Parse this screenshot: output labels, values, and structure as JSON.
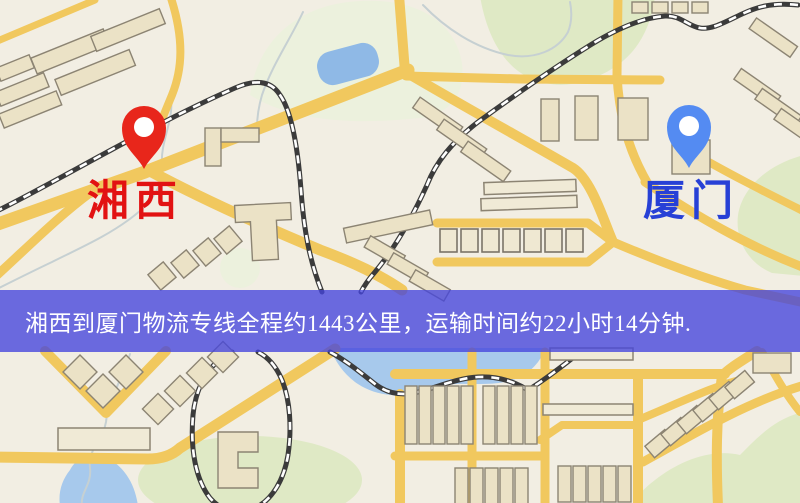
{
  "banner": {
    "text": "湘西到厦门物流专线全程约1443公里，运输时间约22小时14分钟.",
    "background_color": "rgba(68,68,221,0.78)",
    "text_color": "#ffffff"
  },
  "markers": {
    "origin": {
      "label": "湘西",
      "label_color": "#e21212",
      "pin_color": "#e8261b"
    },
    "destination": {
      "label": "厦门",
      "label_color": "#2740d6",
      "pin_color": "#548bf2"
    }
  },
  "map_colors": {
    "background": "#f2eee3",
    "road": "#f1c85e",
    "railway": "#3b3b3b",
    "water": "#8fb9e6",
    "park": "#dfe9c5",
    "building": "#ebe2c6"
  }
}
